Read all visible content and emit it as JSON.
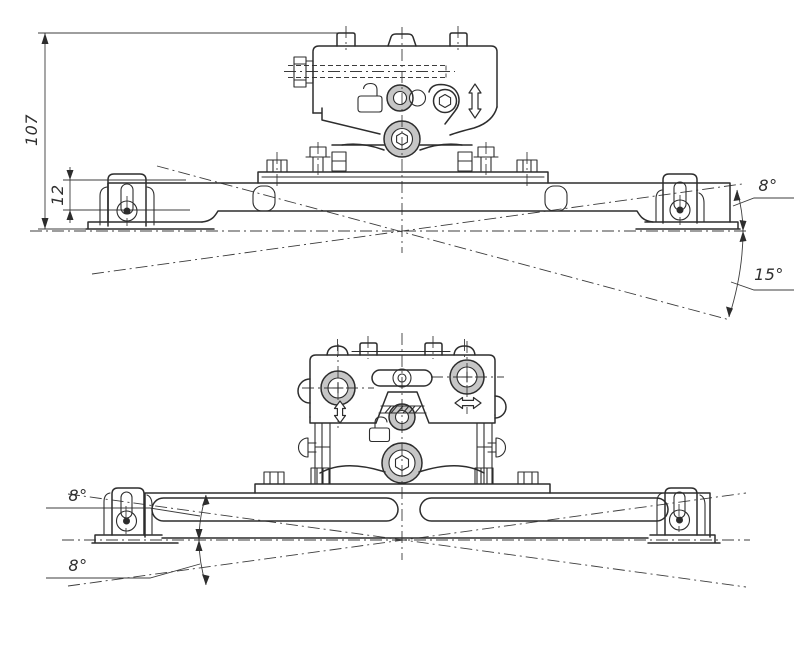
{
  "drawing": {
    "background": "#ffffff",
    "ink_color": "#2d2d2d",
    "shade_color": "#c6c6c6",
    "views": [
      {
        "id": "upper-side-view",
        "dimensions": {
          "height": "107",
          "bracket_offset": "12",
          "tilt_up_angle": "8°",
          "tilt_down_angle": "15°"
        },
        "icons": [
          "unlock-icon",
          "up-down-arrow-icon"
        ]
      },
      {
        "id": "lower-side-view",
        "dimensions": {
          "swivel_up_angle": "8°",
          "swivel_down_angle": "8°"
        },
        "icons": [
          "up-down-arrow-icon",
          "left-right-arrow-icon",
          "unlock-icon",
          "crosshair-screw-icon"
        ]
      }
    ]
  }
}
